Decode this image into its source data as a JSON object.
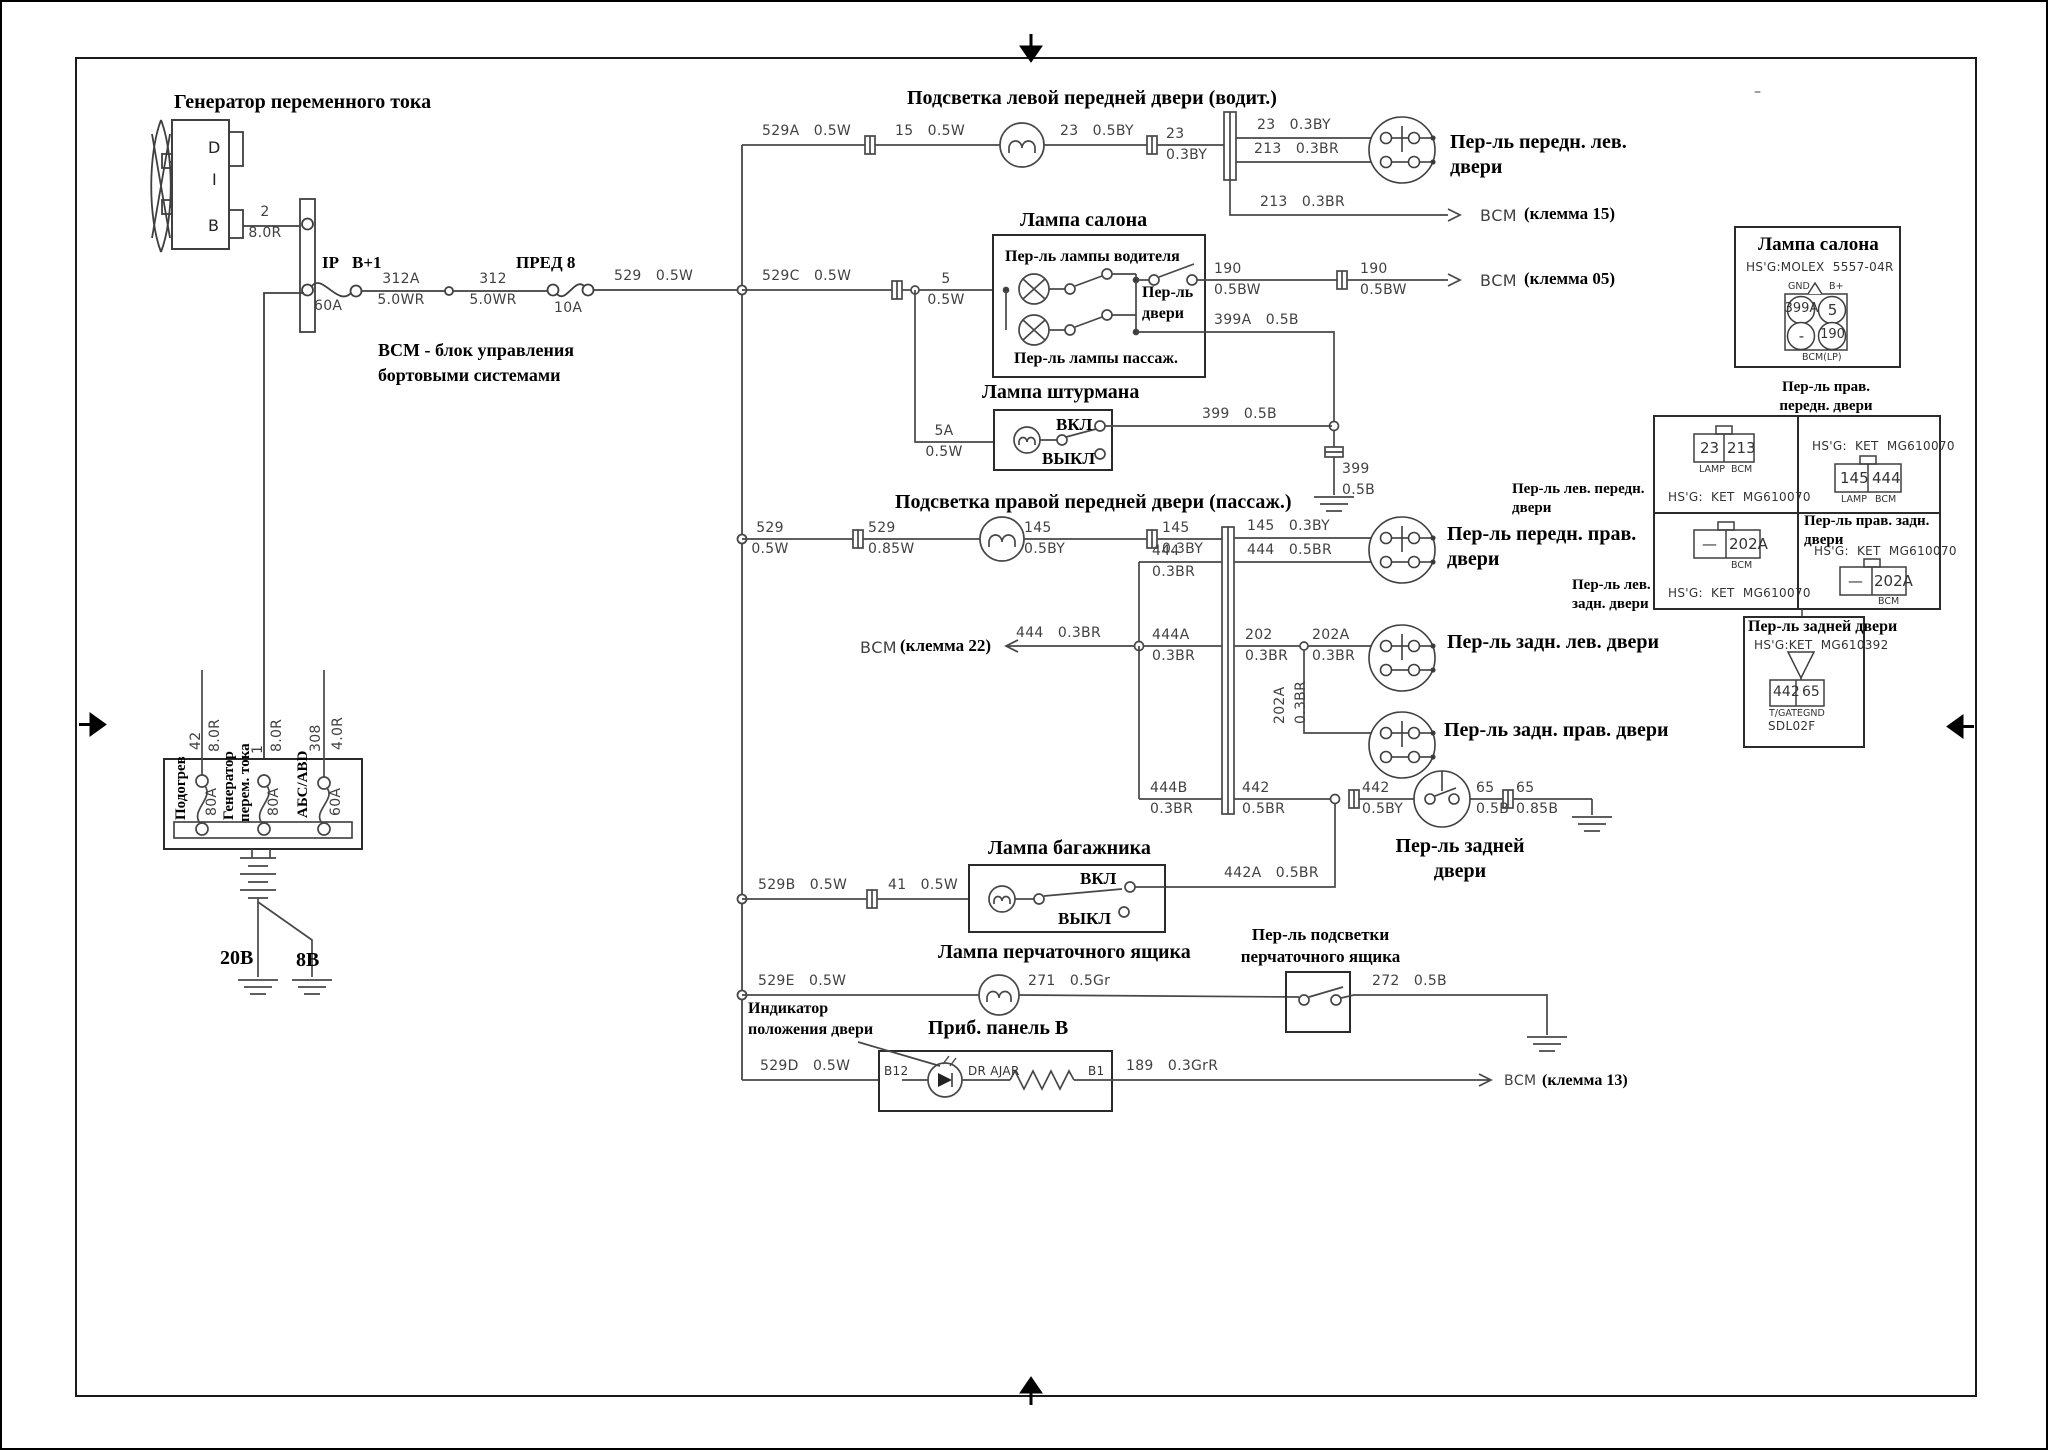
{
  "g": {
    "title": "Генератор переменного тока",
    "pin_d": "D",
    "pin_i": "I",
    "pin_b": "B",
    "w2": "2\n8.0R",
    "ip": "IP",
    "bplus": "B+1",
    "fuse60": "60A",
    "w312a": "312A\n5.0WR",
    "w312": "312\n5.0WR",
    "fuse8": "ПРЕД 8",
    "fuse8_amp": "10A",
    "w529": "529   0.5W"
  },
  "r1": {
    "title": "Подсветка левой передней двери (водит.)",
    "w529a": "529A   0.5W",
    "w15": "15   0.5W",
    "w23a": "23   0.5BY",
    "w23s": "23\n0.3BY",
    "w23b": "23   0.3BY",
    "w213a": "213   0.3BR",
    "sw": "Пер-ль передн. лев.\nдвери",
    "w213b": "213   0.3BR",
    "bcm": "ВСМ",
    "term": "(клемма 15)"
  },
  "r2": {
    "title": "Лампа салона",
    "w529c": "529C   0.5W",
    "w5": "5\n0.5W",
    "drv": "Пер-ль лампы водителя",
    "psg": "Пер-ль лампы пассаж.",
    "door": "Пер-ль\nдвери",
    "w190a": "190\n0.5BW",
    "w190b": "190\n0.5BW",
    "bcm": "ВСМ",
    "term": "(клемма 05)",
    "w399a": "399A   0.5B",
    "w399g": "399\n0.5B"
  },
  "r3": {
    "title": "Лампа штурмана",
    "w5a": "5A\n0.5W",
    "on": "ВКЛ",
    "off": "ВЫКЛ",
    "w399": "399   0.5B"
  },
  "r4": {
    "title": "Подсветка правой передней двери (пассаж.)",
    "w529": "529\n0.5W",
    "w529b": "529\n0.85W",
    "w145a": "145\n0.5BY",
    "w145b": "145\n0.3BY",
    "w145c": "145   0.3BY",
    "w444a": "444   0.5BR",
    "sw": "Пер-ль передн. прав.\nдвери",
    "w444s": "444\n0.3BR"
  },
  "r5": {
    "bcm": "ВСМ",
    "term": "(клемма 22)",
    "w444": "444   0.3BR",
    "w444a": "444A\n0.3BR",
    "w202": "202\n0.3BR",
    "w202a": "202A\n0.3BR",
    "w202v": "202A\n0.3BR",
    "swl": "Пер-ль задн. лев. двери",
    "swr": "Пер-ль задн. прав. двери"
  },
  "r6": {
    "w444b": "444B\n0.3BR",
    "w442a": "442\n0.5BR",
    "w442b": "442\n0.5BY",
    "w65a": "65\n0.5B",
    "w65b": "65\n0.85B",
    "sw": "Пер-ль задней\nдвери",
    "w442c": "442A   0.5BR"
  },
  "r7": {
    "title": "Лампа багажника",
    "w529b": "529B   0.5W",
    "w41": "41   0.5W",
    "on": "ВКЛ",
    "off": "ВЫКЛ"
  },
  "r8": {
    "title": "Лампа перчаточного ящика",
    "sw": "Пер-ль подсветки\nперчаточного ящика",
    "w529e": "529E   0.5W",
    "w271": "271   0.5Gr",
    "w272": "272   0.5B"
  },
  "r9": {
    "ind": "Индикатор\nположения двери",
    "title": "Приб. панель B",
    "w529d": "529D   0.5W",
    "b12": "B12",
    "ajar": "DR AJAR",
    "b1": "B1",
    "w189": "189   0.3GrR",
    "bcm": "ВСМ",
    "term": "(клемма 13)"
  },
  "note": {
    "txt": "ВСМ - блок управления\nбортовыми системами"
  },
  "fb": {
    "w42": "42",
    "g42": "8.0R",
    "w1": "1",
    "g1": "8.0R",
    "w308": "308",
    "g308": "4.0R",
    "f1": "Подогрев",
    "a1": "80А",
    "f2a": "Генератор",
    "f2b": "перем. тока",
    "a2": "80А",
    "f3": "АБС/ABD",
    "a3": "60А",
    "gnd1": "20В",
    "gnd2": "8В"
  },
  "ib": {
    "title": "Лампа салона",
    "hsg": "HS'G:MOLEX  5557-04R",
    "gnd": "GND",
    "bp": "B+",
    "c1": "399A",
    "c2": "5",
    "c3": "-",
    "c4": "190",
    "bcm": "BCM(LP)"
  },
  "grid": {
    "hdr": "Пер-ль прав.\nпередн. двери",
    "hsg": "HS'G:  KET  MG610070",
    "tl1": "23",
    "tl2": "213",
    "lamp": "LAMP",
    "bcm": "BCM",
    "tr1": "145",
    "tr2": "444",
    "bl1": "—",
    "bl2": "202A",
    "br_t": "Пер-ль прав. задн.\nдвери",
    "br1": "—",
    "br2": "202A",
    "lfl": "Пер-ль лев. передн.\nдвери",
    "lrl": "Пер-ль лев.\nзадн. двери"
  },
  "rb": {
    "title": "Пер-ль задней двери",
    "hsg": "HS'G:KET  MG610392",
    "c1": "442",
    "c2": "65",
    "t1": "T/GATE",
    "t2": "GND",
    "t3": "SDL02F"
  },
  "misc": {
    "dash": "–"
  }
}
